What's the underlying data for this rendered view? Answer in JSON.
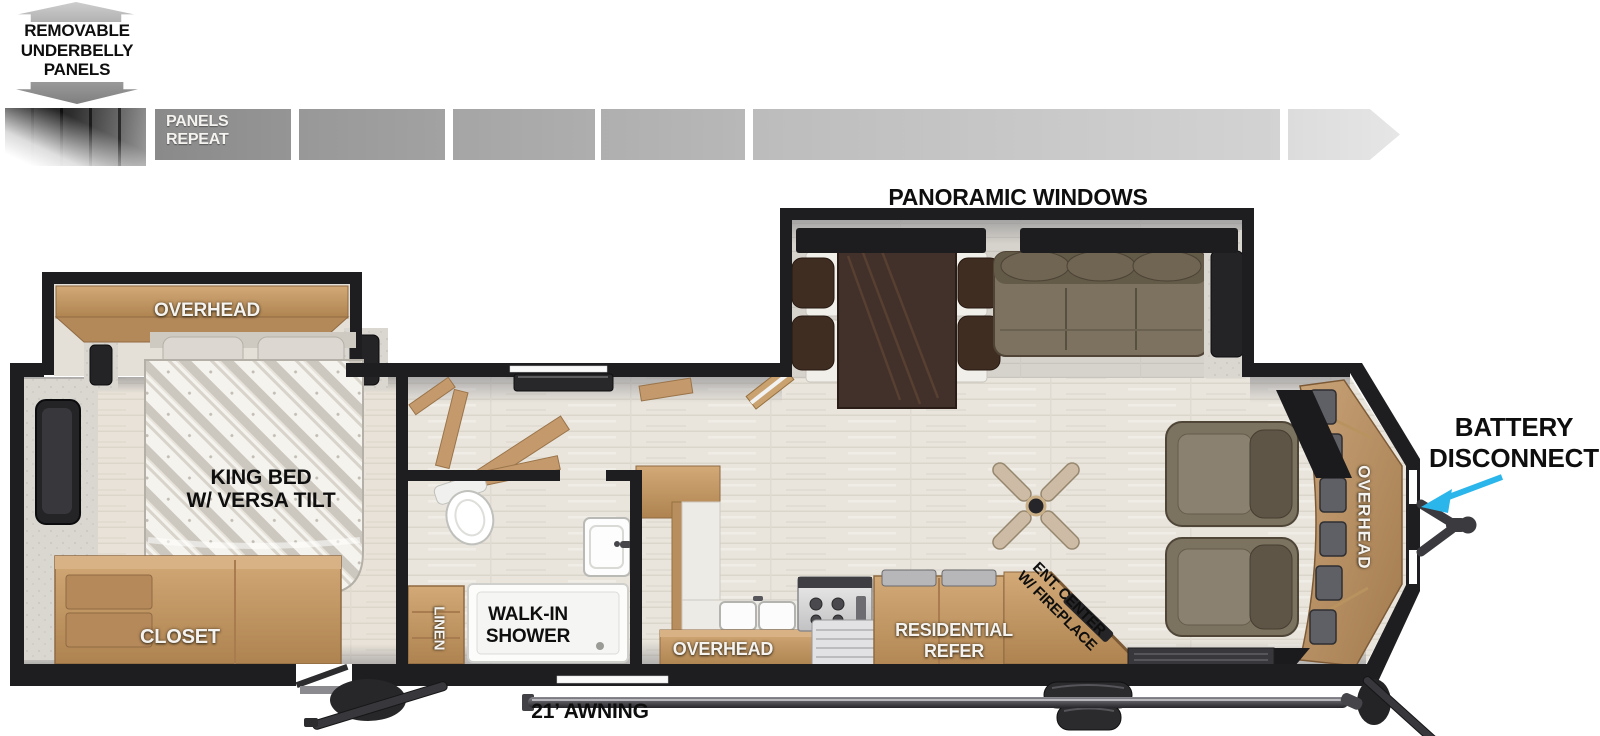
{
  "underbelly_note": {
    "lines": [
      "REMOVABLE",
      "UNDERBELLY",
      "PANELS"
    ]
  },
  "panels_strip": {
    "label": [
      "PANELS",
      "REPEAT"
    ]
  },
  "floorplan": {
    "panoramic_windows": "PANORAMIC WINDOWS",
    "bedroom_overhead": "OVERHEAD",
    "king_bed": [
      "KING BED",
      "W/ VERSA TILT"
    ],
    "closet": "CLOSET",
    "linen": "LINEN",
    "shower": [
      "WALK-IN",
      "SHOWER"
    ],
    "kitchen_overhead": "OVERHEAD",
    "refrigerator": [
      "RESIDENTIAL",
      "REFER"
    ],
    "ent_center": [
      "ENT. CENTER",
      "W/ FIREPLACE"
    ],
    "front_overhead": "OVERHEAD",
    "battery_disconnect": [
      "BATTERY",
      "DISCONNECT"
    ],
    "awning": "21’ AWNING"
  },
  "colors": {
    "wall": "#1e1e20",
    "wood": "#c49a6c",
    "floor": "#e9e5dd",
    "slide_floor": "#d6d3cc",
    "sofa": "#7d7260",
    "accent_arrow": "#2ab6ea",
    "panel_gray": "#9b9b9b"
  }
}
